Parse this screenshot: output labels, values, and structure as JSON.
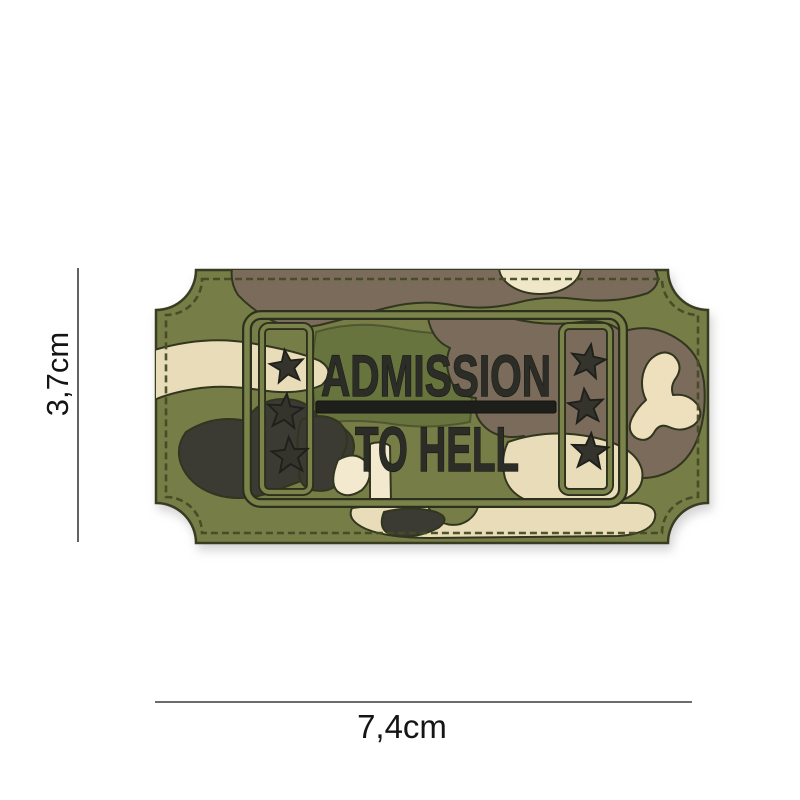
{
  "image": {
    "background_color": "#ffffff",
    "subject": "Woodland camouflage PVC morale patch shaped like an admission ticket, shown with size annotations",
    "patch": {
      "text_line1": "ADMISSION",
      "text_line2": "TO HELL",
      "divider": "solid raised bar between the two text lines",
      "left_star_column_count": 3,
      "right_star_column_count": 3,
      "colors": {
        "olive_base": "#767d47",
        "olive_dark": "#67743e",
        "olive_ridge": "#7b824a",
        "brown": "#7a6b5a",
        "cream": "#e9dcb8",
        "cream_bright": "#f2e9cf",
        "charcoal": "#3b3b33",
        "groove": "#2c311d",
        "lettering": "#2d2d27",
        "stitching": "#454c26"
      }
    },
    "annotations": {
      "height_label": "3,7cm",
      "width_label": "7,4cm",
      "line_color": "#3b3b3b"
    }
  }
}
